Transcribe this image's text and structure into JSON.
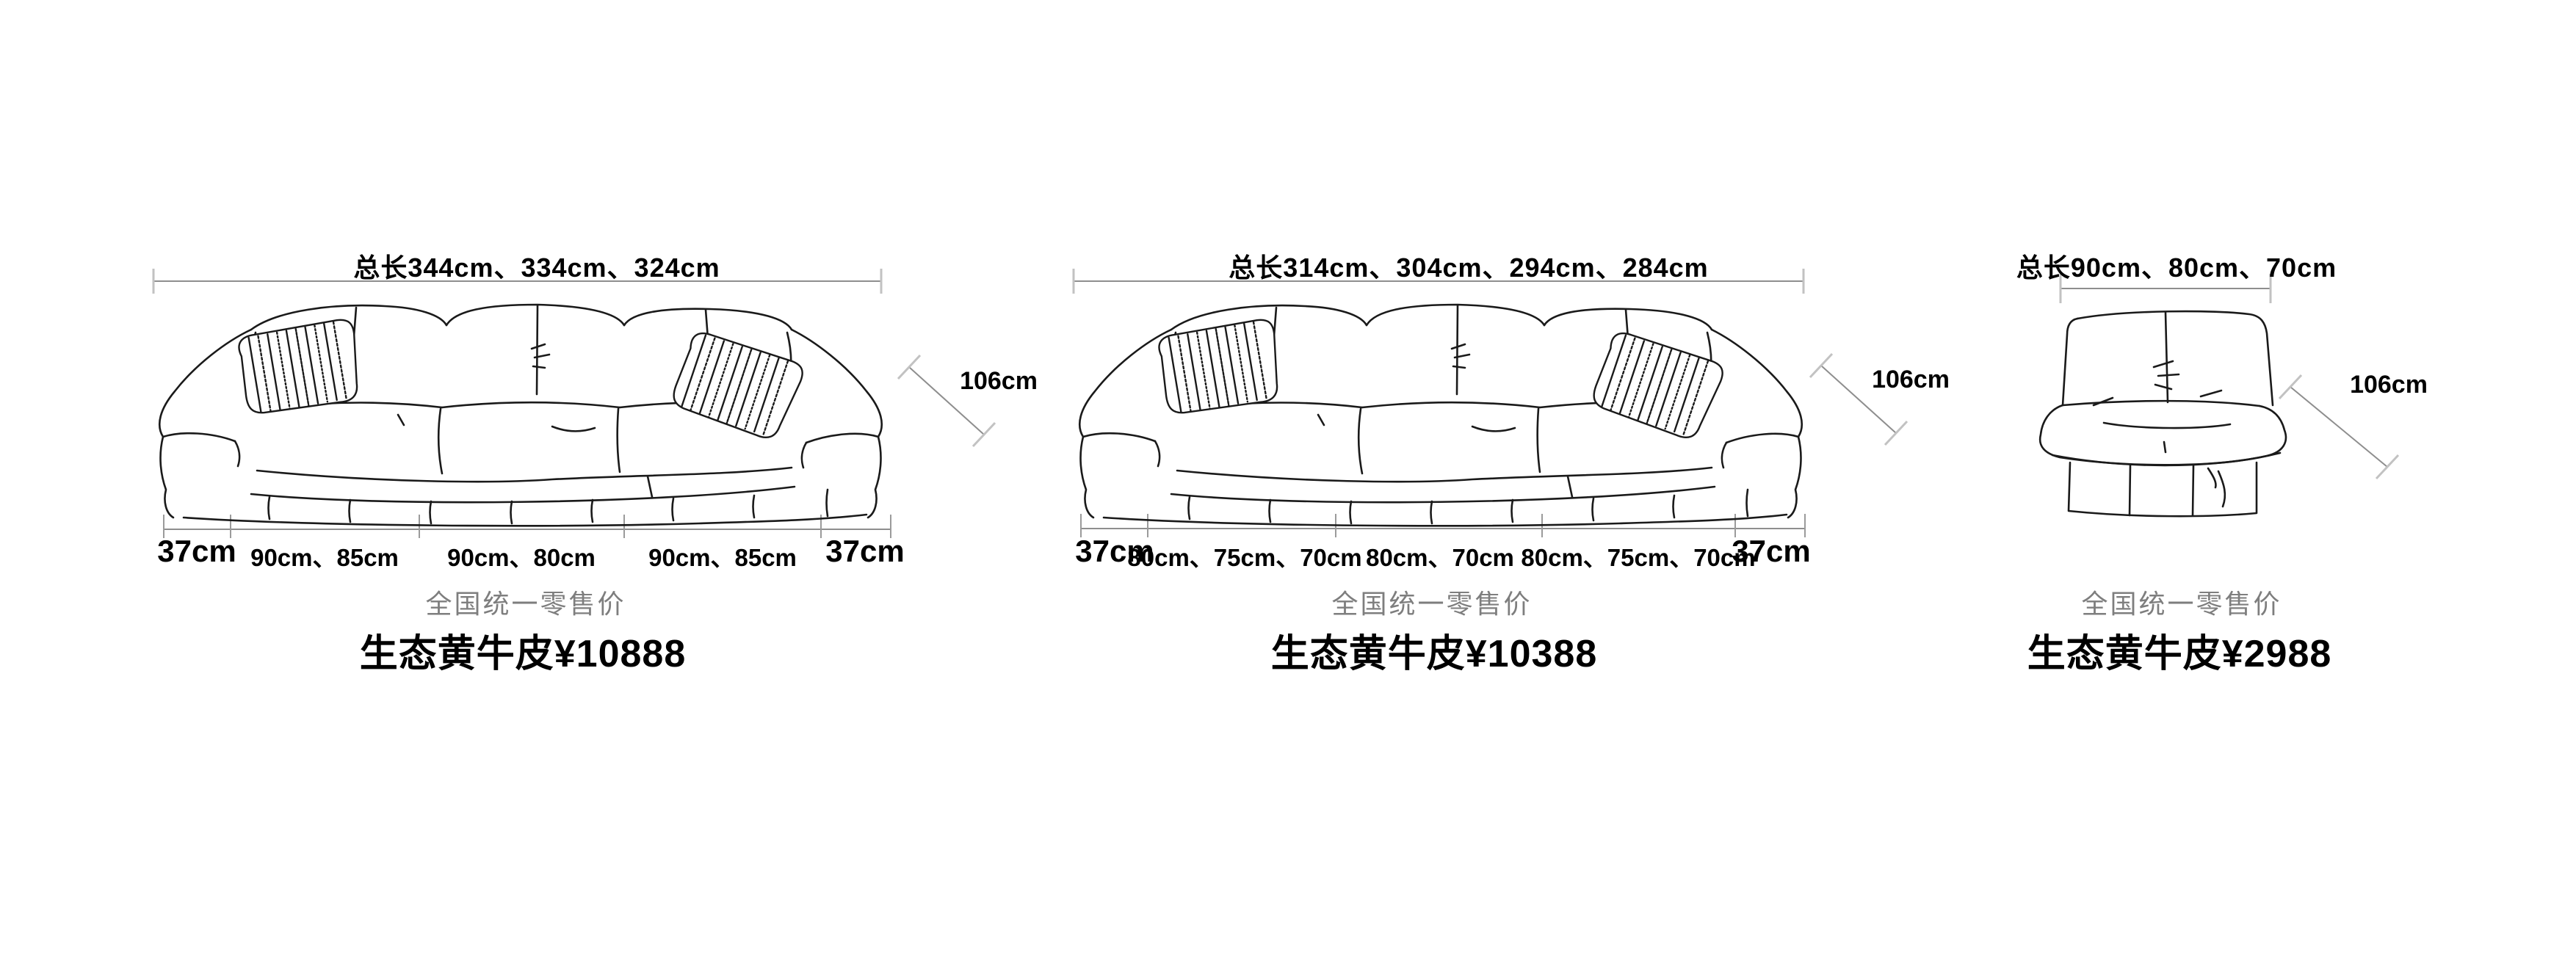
{
  "sheet": {
    "background": "#ffffff"
  },
  "colors": {
    "drawing_line": "#1a1a1a",
    "dimension_line": "#8e8e8e",
    "dimension_tick": "#c2c2c2",
    "caption_text": "#7e7e7e",
    "price_text": "#000000"
  },
  "products": [
    {
      "total_length": "总长344cm、334cm、324cm",
      "height": "106cm",
      "segments": [
        "37cm",
        "90cm、85cm",
        "90cm、80cm",
        "90cm、85cm",
        "37cm"
      ],
      "price_caption": "全国统一零售价",
      "price": "生态黄牛皮¥10888"
    },
    {
      "total_length": "总长314cm、304cm、294cm、284cm",
      "height": "106cm",
      "segments": [
        "37cm",
        "80cm、75cm、70cm",
        "80cm、70cm",
        "80cm、75cm、70cm",
        "37cm"
      ],
      "price_caption": "全国统一零售价",
      "price": "生态黄牛皮¥10388"
    },
    {
      "total_length": "总长90cm、80cm、70cm",
      "height": "106cm",
      "price_caption": "全国统一零售价",
      "price": "生态黄牛皮¥2988"
    }
  ]
}
